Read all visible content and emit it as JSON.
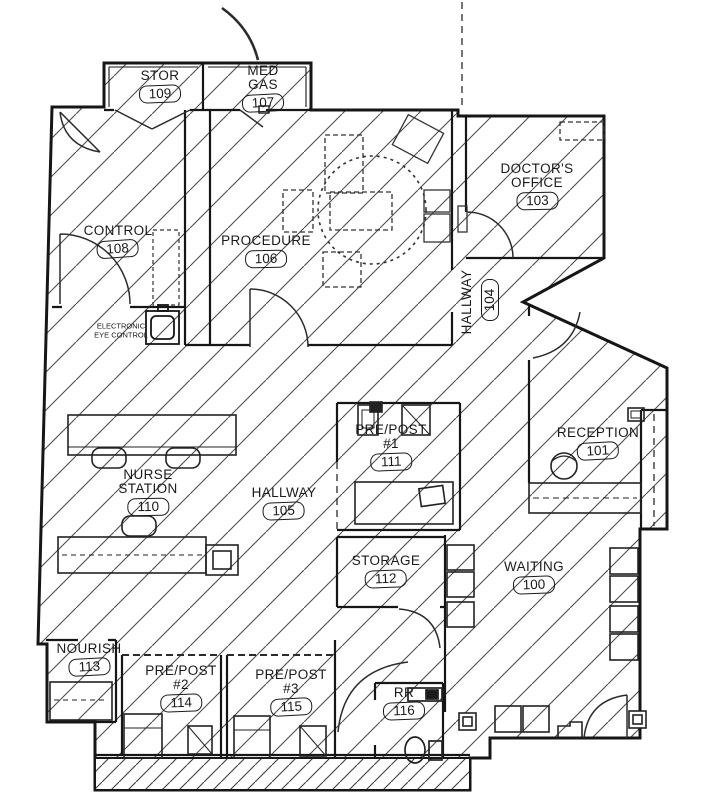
{
  "rooms": {
    "stor": {
      "lines": [
        "STOR"
      ],
      "number": "109"
    },
    "med_gas": {
      "lines": [
        "MED",
        "GAS"
      ],
      "number": "107"
    },
    "doctors_office": {
      "lines": [
        "DOCTOR'S",
        "OFFICE"
      ],
      "number": "103"
    },
    "control": {
      "lines": [
        "CONTROL"
      ],
      "number": "108"
    },
    "procedure": {
      "lines": [
        "PROCEDURE"
      ],
      "number": "106"
    },
    "hallway_104": {
      "lines": [
        "HALLWAY"
      ],
      "number": "104"
    },
    "electronic_eye": {
      "lines": [
        "ELECTRONIC",
        "EYE CONTROL"
      ]
    },
    "pre_post_1": {
      "lines": [
        "PRE/POST",
        "#1"
      ],
      "number": "111"
    },
    "reception": {
      "lines": [
        "RECEPTION"
      ],
      "number": "101"
    },
    "nurse_station": {
      "lines": [
        "NURSE",
        "STATION"
      ],
      "number": "110"
    },
    "hallway_105": {
      "lines": [
        "HALLWAY"
      ],
      "number": "105"
    },
    "storage": {
      "lines": [
        "STORAGE"
      ],
      "number": "112"
    },
    "waiting": {
      "lines": [
        "WAITING"
      ],
      "number": "100"
    },
    "nourish": {
      "lines": [
        "NOURISH"
      ],
      "number": "113"
    },
    "pre_post_2": {
      "lines": [
        "PRE/POST",
        "#2"
      ],
      "number": "114"
    },
    "pre_post_3": {
      "lines": [
        "PRE/POST",
        "#3"
      ],
      "number": "115"
    },
    "rr": {
      "lines": [
        "RR"
      ],
      "number": "116"
    }
  },
  "colors": {
    "ink": "#1a1a1a",
    "hatch": "#4d4d4d",
    "paper": "#ffffff"
  }
}
